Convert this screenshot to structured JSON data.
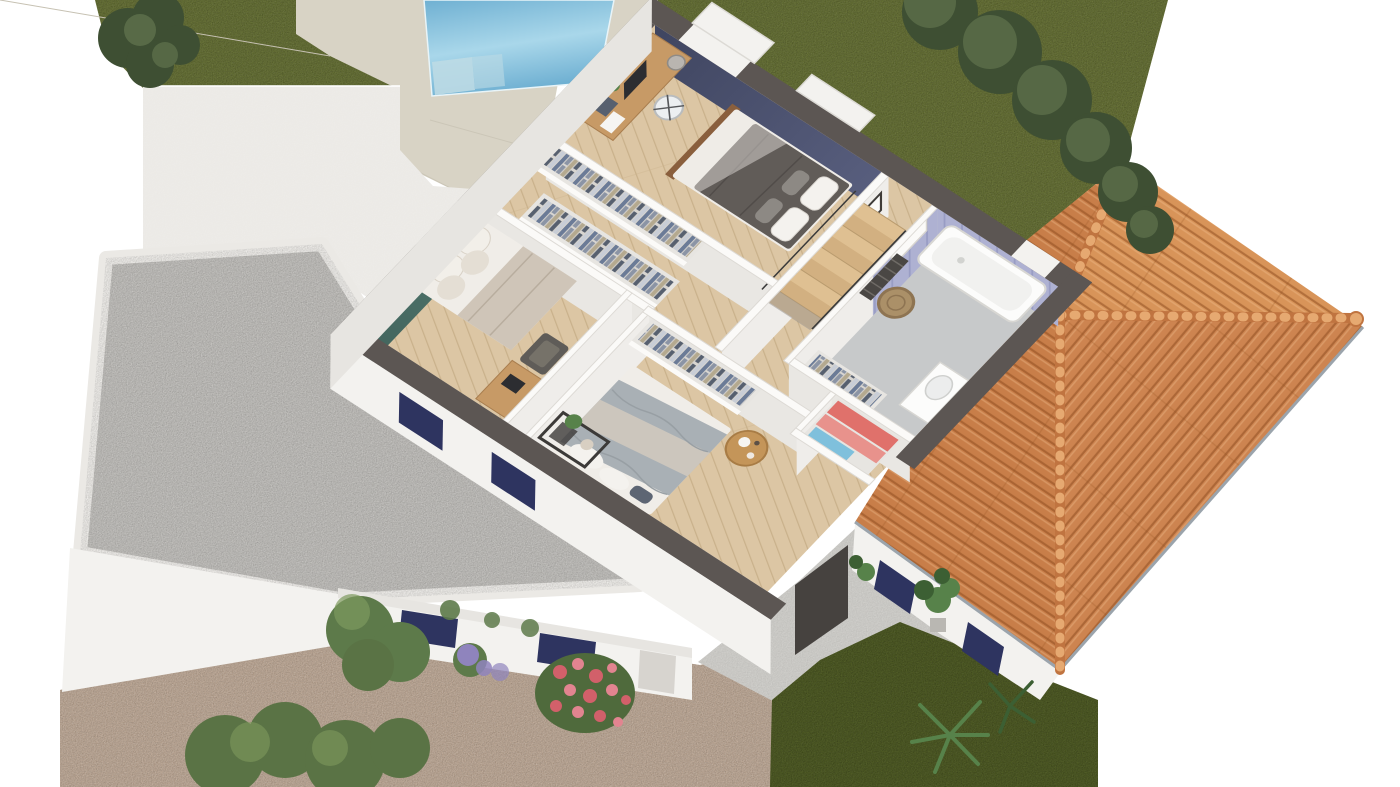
{
  "palette": {
    "bg": "#ffffff",
    "grass": "#5f6a2c",
    "grassLight": "#76823a",
    "grassDark": "#49561d",
    "hedge": "#3e4f33",
    "hedgeLight": "#6d8257",
    "bush": "#5a7345",
    "bushLight": "#7e9a5e",
    "poolWater1": "#6fb0d2",
    "poolWater2": "#a9d7ea",
    "poolStep": "#bcdae4",
    "deck": "#d8d3c5",
    "deckLine": "#c6c1b2",
    "flatRoof": "#ebe9e5",
    "wallLight": "#f3f2ef",
    "wallMid": "#e7e5e1",
    "wallShade": "#d7d4cf",
    "gravelGray": "#b7b5b1",
    "gravelBrown": "#b59e8a",
    "terrace": "#d0cfcb",
    "cutWall": "#5c5653",
    "floorWood": "#dcc6a4",
    "plankLine": "#c9b18b",
    "bathFloor": "#c7c9ca",
    "navyWall1": "#5a6080",
    "navyWall2": "#3f4560",
    "tealWall": "#52796f",
    "lavWall": "#aeb1d2",
    "lavStripe": "#8e92bd",
    "partFace": "#e9e7e3",
    "partFace2": "#efedea",
    "wallTop": "#fbfaf8",
    "roofNE": "#d89459",
    "roofSE": "#cd8450",
    "roofSW": "#c87e49",
    "roofLine": "#a35f2d",
    "capFill": "#c07440",
    "capLight": "#e6a971",
    "eaveTrim": "#9ba4ac",
    "stairWood": "#dfc092",
    "stairWood2": "#d2b081",
    "railing": "#3a3a3a",
    "bedDuvetDark": "#615c58",
    "bedSheet": "#efece7",
    "pillowGray": "#8d8984",
    "bedFrame": "#8a5f3d",
    "blanketBeige": "#cfc5b8",
    "duvetWhite": "#f0ede8",
    "blanketGray": "#a9b0b5",
    "knit": "#ccc6bd",
    "pillowNavy": "#5d6573",
    "deskWood": "#c79a66",
    "monitor": "#2c2d31",
    "chairWhite": "#eceff1",
    "clothes1": "#6b7b97",
    "clothes2": "#8b94a5",
    "clothes3": "#b4a98f",
    "clothes4": "#57606f",
    "clothes5": "#c8cdd6",
    "closetBack": "#d8d5d0",
    "tub": "#fcfcfb",
    "towelRad": "#4a4744",
    "basket": "#ab9068",
    "towelRed": "#e0716b",
    "towelPink": "#e8928c",
    "towelBlue": "#7fc0dc",
    "tableWood": "#c49559",
    "shelfDark": "#3c3a38",
    "plantGreen": "#57824a",
    "plantDark": "#3c5f33",
    "windowNavy": "#2e3460",
    "doorway": "#46423f",
    "flowerPink": "#d2606a",
    "flowerPink2": "#e28490",
    "flowerPurple": "#8f84bd",
    "foliage": "#5d7a4a"
  },
  "scene": {
    "type": "isometric-floor-plan-render",
    "floor": "upper-floor-cutaway",
    "rooms": [
      {
        "name": "master-bedroom",
        "accent_wall": "navy",
        "furniture": [
          "double-bed-dark-duvet",
          "desk-with-monitor",
          "chair",
          "pendant-lamp"
        ]
      },
      {
        "name": "dressing-room",
        "furniture": [
          "wardrobe-rail-upper",
          "wardrobe-rail-lower"
        ]
      },
      {
        "name": "left-bedroom",
        "accent_wall": "teal",
        "furniture": [
          "double-bed-white-beige",
          "armchair",
          "desk"
        ]
      },
      {
        "name": "stair-hall",
        "furniture": [
          "winder-staircase",
          "wall-pictures",
          "radiator-panel"
        ]
      },
      {
        "name": "bathroom",
        "accent_wall": "lavender-tiles",
        "furniture": [
          "bathtub",
          "towel-radiator",
          "wicker-basket",
          "vanity"
        ]
      },
      {
        "name": "linen-closet",
        "furniture": [
          "towel-shelves-red-pink-blue",
          "wardrobe-rail"
        ]
      },
      {
        "name": "bottom-bedroom",
        "furniture": [
          "double-bed-gray-knit",
          "round-side-table",
          "black-shelf-unit",
          "wardrobe-rail"
        ]
      }
    ],
    "exterior": [
      "swimming-pool",
      "pool-deck",
      "lawn-top",
      "tree-hedge",
      "shrubs",
      "white-flat-roof-wing",
      "gravel-courtyard",
      "gravel-driveway",
      "terracotta-hip-roof",
      "garage-wall-navy-windows",
      "ground-terrace",
      "front-wall-navy-windows",
      "flower-bed-pink",
      "flower-bed-purple",
      "palm-plants",
      "monstera-plant"
    ]
  }
}
